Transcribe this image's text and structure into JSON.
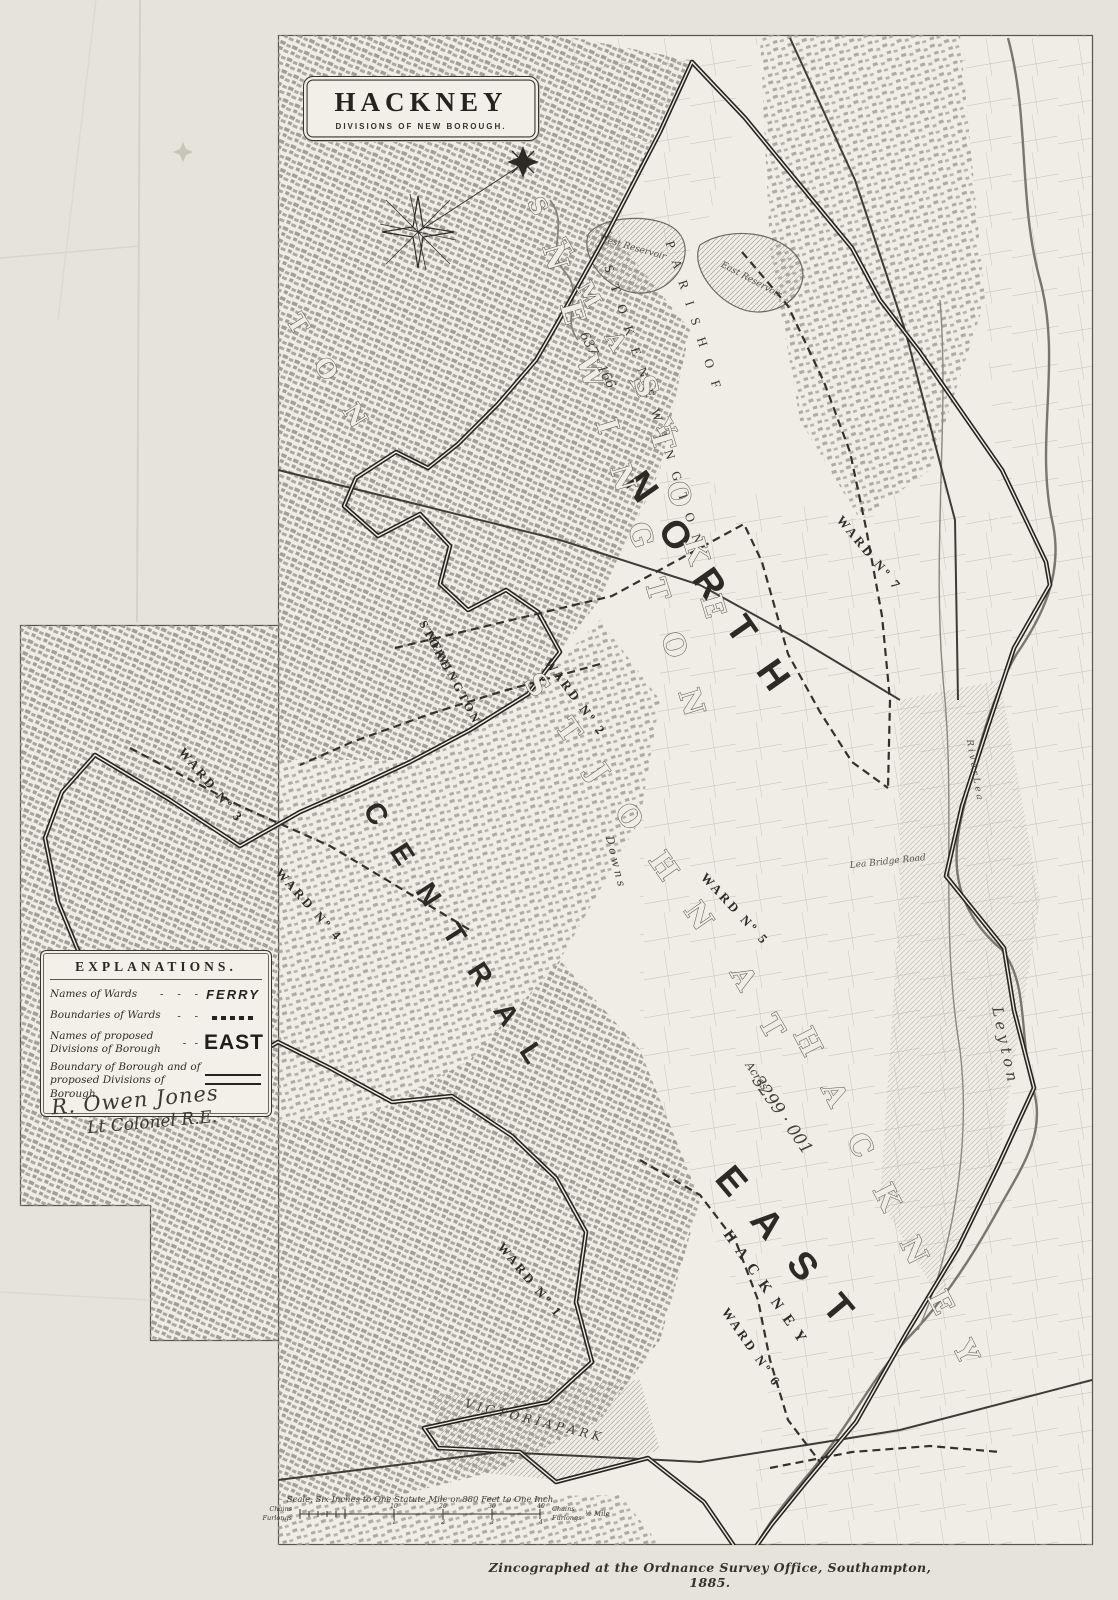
{
  "title": {
    "main": "HACKNEY",
    "sub": "DIVISIONS OF NEW BOROUGH."
  },
  "explanations": {
    "heading": "EXPLANATIONS.",
    "rows": [
      {
        "label": "Names of Wards",
        "sample": "FERRY",
        "symbol": "text-sample"
      },
      {
        "label": "Boundaries of Wards",
        "sample": "- - - - -",
        "symbol": "dashed-line"
      },
      {
        "label": "Names of proposed Divisions of Borough",
        "sample": "EAST",
        "symbol": "bold-text-sample"
      },
      {
        "label": "Boundary of Borough and of proposed Divisions of Borough",
        "sample": "",
        "symbol": "double-rule"
      }
    ]
  },
  "signature": {
    "line1": "R. Owen Jones",
    "line2": "Lt Colonel R.E."
  },
  "imprint": "Zincographed at the Ordnance Survey Office, Southampton, 1885.",
  "scalebar": {
    "caption": "Scale, Six Inches to One Statute Mile or 880 Feet to One Inch",
    "left_top": "Chains",
    "left_bottom": "Furlongs",
    "right_top": "Chains",
    "right_bottom": "Furlongs",
    "end": "½ Mile",
    "chain_ticks": [
      "10",
      "20",
      "30",
      "40"
    ],
    "furlong_ticks": [
      "1",
      "2",
      "3",
      "4"
    ]
  },
  "colors": {
    "paper": "#e6e3da",
    "plate": "#efede5",
    "ink": "#2c2a25",
    "boundary": "#26241f"
  },
  "map_labels": [
    {
      "name": "division-north",
      "text": "N O R T H",
      "x": 700,
      "y": 592,
      "rot": 55,
      "cls": "div",
      "size": 38
    },
    {
      "name": "division-central",
      "text": "C E N T R A L",
      "x": 448,
      "y": 942,
      "rot": 57,
      "cls": "div",
      "size": 29
    },
    {
      "name": "division-east",
      "text": "E A S T",
      "x": 778,
      "y": 1256,
      "rot": 50,
      "cls": "div",
      "size": 38
    },
    {
      "name": "parish-of-label",
      "text": "P A R I S H   O F",
      "x": 690,
      "y": 318,
      "rot": 72,
      "cls": "parish",
      "size": 13
    },
    {
      "name": "parish-stoke-newington",
      "text": "S T O K E   N E W I N G T O N",
      "x": 650,
      "y": 408,
      "rot": 72,
      "cls": "parish",
      "size": 13
    },
    {
      "name": "st-mary-outline",
      "text": "S T   M A R Y",
      "x": 598,
      "y": 326,
      "rot": 60,
      "cls": "outline",
      "size": 23
    },
    {
      "name": "stoke-outline",
      "text": "S T O K E",
      "x": 672,
      "y": 505,
      "rot": 73,
      "cls": "outline",
      "size": 29
    },
    {
      "name": "newington-outline",
      "text": "N E W I N G T O N",
      "x": 616,
      "y": 488,
      "rot": 73,
      "cls": "outline",
      "size": 29
    },
    {
      "name": "st-john-outline",
      "text": "S T   J O H N",
      "x": 614,
      "y": 812,
      "rot": 55,
      "cls": "outline",
      "size": 29
    },
    {
      "name": "at-outline",
      "text": "A T",
      "x": 752,
      "y": 1012,
      "rot": 60,
      "cls": "outline",
      "size": 29
    },
    {
      "name": "hackney-outline",
      "text": "H A C K N E Y",
      "x": 880,
      "y": 1205,
      "rot": 63,
      "cls": "outline",
      "size": 29
    },
    {
      "name": "ton-outline",
      "text": "T O N",
      "x": 323,
      "y": 380,
      "rot": 58,
      "cls": "outline",
      "size": 25
    },
    {
      "name": "ward-no-2-label",
      "text": "WARD Nº 2",
      "x": 572,
      "y": 700,
      "rot": 53,
      "cls": "ward",
      "size": 13
    },
    {
      "name": "ward-no-5-label",
      "text": "WARD Nº 5",
      "x": 732,
      "y": 912,
      "rot": 47,
      "cls": "ward",
      "size": 13
    },
    {
      "name": "ward-no-7-label",
      "text": "WARD Nº 7",
      "x": 866,
      "y": 556,
      "rot": 50,
      "cls": "ward",
      "size": 13
    },
    {
      "name": "ward-no-3-label",
      "text": "WARD Nº 3",
      "x": 208,
      "y": 788,
      "rot": 50,
      "cls": "ward",
      "size": 13
    },
    {
      "name": "ward-no-4-label",
      "text": "WARD Nº 4",
      "x": 306,
      "y": 908,
      "rot": 48,
      "cls": "ward",
      "size": 13
    },
    {
      "name": "ward-no-6-label",
      "text": "WARD Nº 6",
      "x": 748,
      "y": 1350,
      "rot": 55,
      "cls": "ward",
      "size": 13
    },
    {
      "name": "ward-no-1-label",
      "text": "WARD Nº 1",
      "x": 527,
      "y": 1283,
      "rot": 50,
      "cls": "ward",
      "size": 13
    },
    {
      "name": "stoke-small-label",
      "text": "STOKE",
      "x": 432,
      "y": 648,
      "rot": 62,
      "cls": "ward",
      "size": 12
    },
    {
      "name": "newington-small-label",
      "text": "NEWINGTON",
      "x": 450,
      "y": 680,
      "rot": 62,
      "cls": "ward",
      "size": 12
    },
    {
      "name": "hackney-ward-caps",
      "text": "H A C K N E Y",
      "x": 762,
      "y": 1290,
      "rot": 55,
      "cls": "ward",
      "size": 15
    },
    {
      "name": "west-reservoir-label",
      "text": "West Reservoir",
      "x": 632,
      "y": 250,
      "rot": 16,
      "cls": "tiny",
      "size": 9
    },
    {
      "name": "east-reservoir-label",
      "text": "East Reservoir",
      "x": 750,
      "y": 282,
      "rot": 28,
      "cls": "tiny",
      "size": 9
    },
    {
      "name": "area-figure-637",
      "text": "637 · 166",
      "x": 594,
      "y": 362,
      "rot": 62,
      "cls": "figure",
      "size": 13
    },
    {
      "name": "acres-word",
      "text": "Acres",
      "x": 754,
      "y": 1078,
      "rot": 55,
      "cls": "figure",
      "size": 11
    },
    {
      "name": "area-figure-3299",
      "text": "3299 · 001",
      "x": 778,
      "y": 1118,
      "rot": 55,
      "cls": "figure",
      "size": 17
    },
    {
      "name": "leyton-label",
      "text": "L e y t o n",
      "x": 1000,
      "y": 1045,
      "rot": 78,
      "cls": "figure",
      "size": 15
    },
    {
      "name": "hackney-downs-label",
      "text": "D o w n s",
      "x": 612,
      "y": 862,
      "rot": 76,
      "cls": "figure",
      "size": 11
    },
    {
      "name": "victoria-park-label",
      "text": "V I C T O R I A   P A R K",
      "x": 532,
      "y": 1424,
      "rot": 14,
      "cls": "figure",
      "size": 12
    },
    {
      "name": "lea-bridge-road-label",
      "text": "Lea Bridge Road",
      "x": 888,
      "y": 864,
      "rot": -6,
      "cls": "tiny",
      "size": 9
    },
    {
      "name": "river-lea-label",
      "text": "R i v e r   L e a",
      "x": 972,
      "y": 770,
      "rot": 80,
      "cls": "tiny",
      "size": 10
    }
  ]
}
